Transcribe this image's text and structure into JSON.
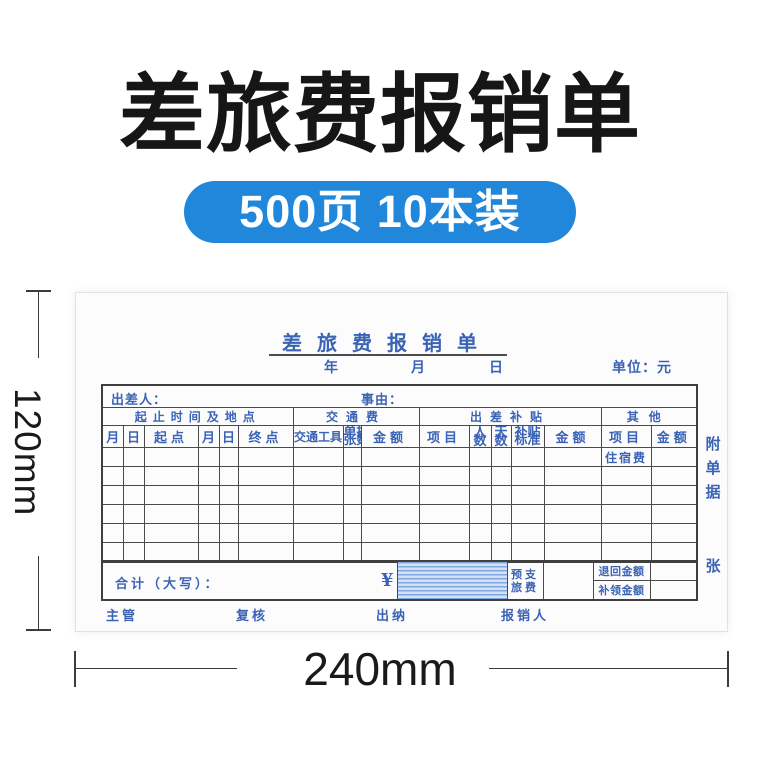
{
  "product": {
    "title": "差旅费报销单",
    "badge": "500页 10本装"
  },
  "measurements": {
    "height": "120mm",
    "width": "240mm"
  },
  "form": {
    "title": "差旅费报销单",
    "date": {
      "year": "年",
      "month": "月",
      "day": "日"
    },
    "unit": "单位：元",
    "traveler": "出差人：",
    "reason": "事由：",
    "groups": {
      "time_place": "起止时间及地点",
      "transport": "交通费",
      "allowance": "出差补贴",
      "other": "其他"
    },
    "columns": [
      "月",
      "日",
      "起点",
      "月",
      "日",
      "终点",
      "交通工具",
      "单据张数",
      "金额",
      "项目",
      "人数",
      "天数",
      "补贴标准",
      "金额",
      "项目",
      "金额"
    ],
    "rows": {
      "first_other_item": "住宿费"
    },
    "footer": {
      "total": "合计（大写）：",
      "yen": "¥",
      "advance_line1": "预支",
      "advance_line2": "旅费",
      "refund": "退回金额",
      "supplement": "补领金额"
    },
    "attachment": {
      "char1": "附",
      "char2": "单",
      "char3": "据",
      "suffix": "张"
    },
    "signatures": [
      "主管",
      "复核",
      "出纳",
      "报销人"
    ]
  }
}
